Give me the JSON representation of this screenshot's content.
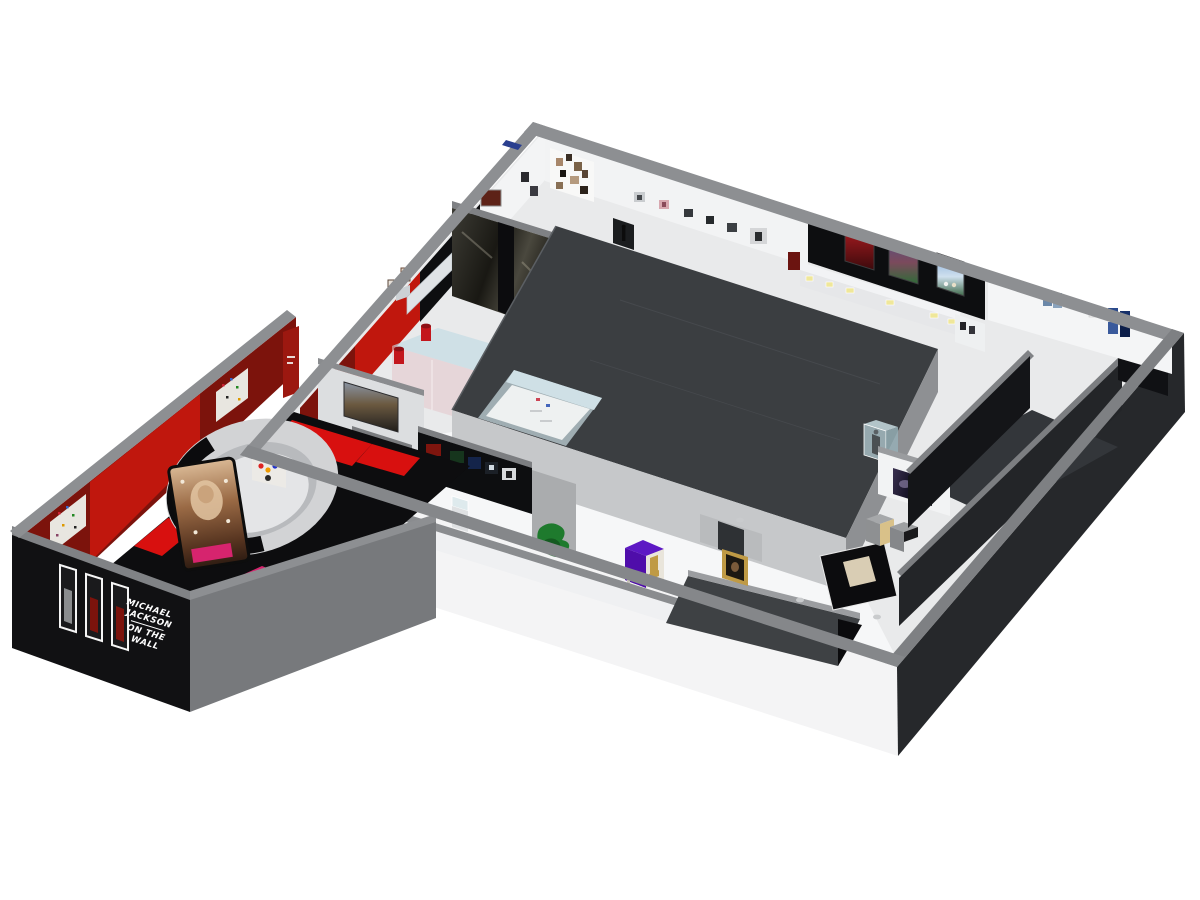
{
  "sign": {
    "line1": "MICHAEL",
    "line2": "JACKSON",
    "line3": "ON THE",
    "line4": "WALL"
  },
  "palette": {
    "background": "#ffffff",
    "wall_cap": "#8d8f92",
    "wall_cap_dark": "#77797c",
    "exterior_dark": "#26282b",
    "annex_end_gray": "#77797c",
    "black_wall": "#0d0e10",
    "red_wall_bright": "#c0170d",
    "red_wall_dark": "#7c130c",
    "carpet_red": "#d8100f",
    "magenta_carpet": "#d6246e",
    "floor_light": "#e9eaeb",
    "floor_white": "#f6f7f8",
    "corridor_floor": "#33363a",
    "block_top": "#3b3e41",
    "block_side_light": "#c6c8ca",
    "block_side_gray": "#8e9093",
    "drum_outer": "#d2d3d5",
    "drum_inner": "#b8babd",
    "glass_blue": "#cfe0e6",
    "glass_pink": "#e3c4ca",
    "purple_crate": "#4f0daa",
    "purple_crate_top": "#5d18c4",
    "gold": "#bf9a45",
    "green_sculpture": "#1e7a2d",
    "bench_white": "#e6e7e9",
    "sign_text": "#ffffff"
  }
}
